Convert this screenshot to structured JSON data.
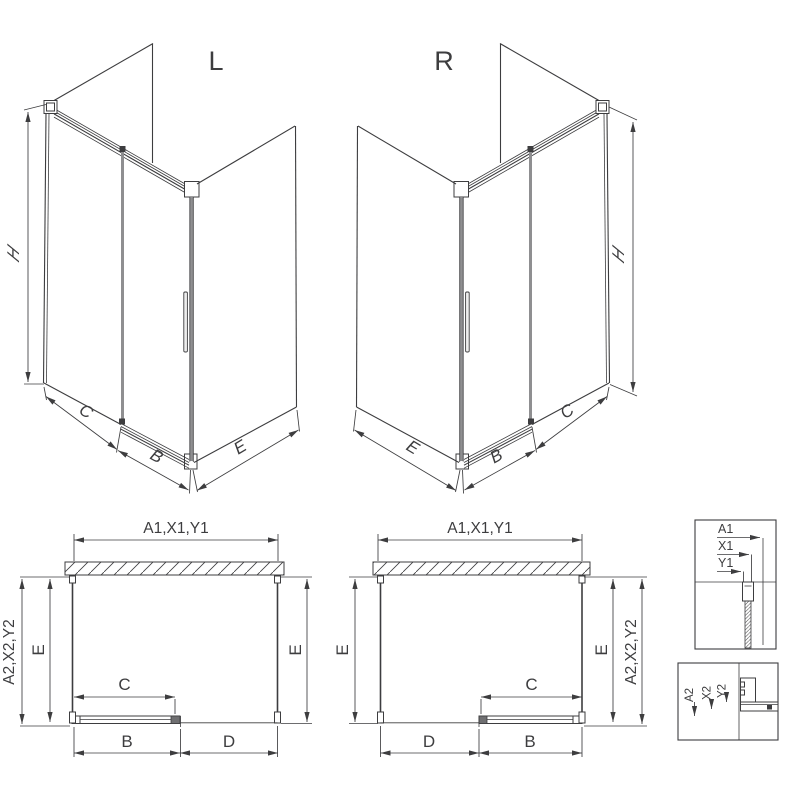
{
  "colors": {
    "line": "#3d3d3f",
    "gray_profile": "#8f8f91",
    "background": "#ffffff"
  },
  "iso_left": {
    "label": "L",
    "dim_h": "H",
    "dim_c": "C",
    "dim_b": "B",
    "dim_e": "E"
  },
  "iso_right": {
    "label": "R",
    "dim_h": "H",
    "dim_c": "C",
    "dim_b": "B",
    "dim_e": "E"
  },
  "plan_left": {
    "dim_top": "A1,X1,Y1",
    "dim_side": "A2,X2,Y2",
    "dim_e_left": "E",
    "dim_e_right": "E",
    "dim_c": "C",
    "dim_b": "B",
    "dim_d": "D"
  },
  "plan_right": {
    "dim_top": "A1,X1,Y1",
    "dim_side": "A2,X2,Y2",
    "dim_e_left": "E",
    "dim_e_right": "E",
    "dim_c": "C",
    "dim_b": "B",
    "dim_d": "D"
  },
  "detail_top": {
    "dim_a1": "A1",
    "dim_x1": "X1",
    "dim_y1": "Y1"
  },
  "detail_bottom": {
    "dim_a2": "A2",
    "dim_x2": "X2",
    "dim_y2": "Y2"
  }
}
